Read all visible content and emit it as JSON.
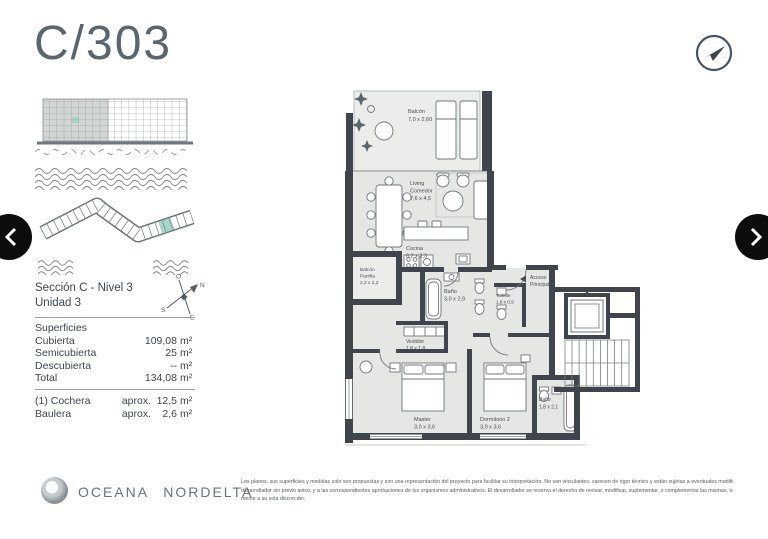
{
  "page": {
    "title": "C/303"
  },
  "colors": {
    "accent_teal": "#a5d7c9",
    "wall": "#3f454a",
    "interior": "#e5e7e5",
    "title_gray": "#5b656d",
    "nav_black": "#0d0d0d"
  },
  "sidebar": {
    "section": {
      "line1": "Sección C - Nivel 3",
      "line2": "Unidad 3"
    },
    "compass": {
      "n": "N",
      "s": "S",
      "e": "E",
      "o": "O"
    },
    "surfaces": {
      "header": "Superficies",
      "rows": [
        {
          "label": "Cubierta",
          "value": "109,08",
          "unit": "m²"
        },
        {
          "label": "Semicubierta",
          "value": "25",
          "unit": "m²"
        },
        {
          "label": "Descubierta",
          "value": "--",
          "unit": "m²"
        },
        {
          "label": "Total",
          "value": "134,08",
          "unit": "m²"
        }
      ],
      "extras": [
        {
          "label": "(1) Cochera",
          "prefix": "aprox.",
          "value": "12,5",
          "unit": "m²"
        },
        {
          "label": "Baulera",
          "prefix": "aprox.",
          "value": "2,6",
          "unit": "m²"
        }
      ]
    }
  },
  "plan": {
    "balcon": {
      "name": "Balcón",
      "dim": "7,0 x 2,60"
    },
    "living": {
      "name1": "Living",
      "name2": "Comedor",
      "dim": "7,6 x 4,5"
    },
    "cocina": {
      "name": "Cocina",
      "dim": "6,2 x 2,3"
    },
    "parrilla": {
      "name1": "Balcón",
      "name2": "Parrilla",
      "dim": "2,2 x 2,2"
    },
    "bano": {
      "name": "Baño",
      "dim": "3,0 x 2,9"
    },
    "vestidor": {
      "name": "Vestidor",
      "dim": "1,8 x 1,8"
    },
    "toilette": {
      "name": "Toilette",
      "dim": "1,8 x 0,9"
    },
    "acceso": {
      "name1": "Acceso",
      "name2": "Principal"
    },
    "master": {
      "name": "Master",
      "dim": "3,0 x 3,6"
    },
    "dormitorio2": {
      "name": "Dormitorio 2",
      "dim": "3,0 x 3,6"
    },
    "bano2": {
      "name": "Baño",
      "dim": "1,8 x 2,1"
    }
  },
  "footer": {
    "brand": "OCEANA NORDELTA",
    "disclaimer": {
      "line1": "Los planos, sus superficies y medidas solo son propuestas y son una representación del proyecto para facilitar su interpretación. No son vinculantes, carecen de rigor técnico y están sujetas a eventuales modificaciones del",
      "line2": "desarrollador sin previo aviso, y a las correspondientes aprobaciones de los organismos administrativos. El desarrollador se reserva el derecho de revisar, modificar, suplementar, o complementar las mismas, total o parcial-",
      "line3": "mente a su sola discreción."
    }
  }
}
